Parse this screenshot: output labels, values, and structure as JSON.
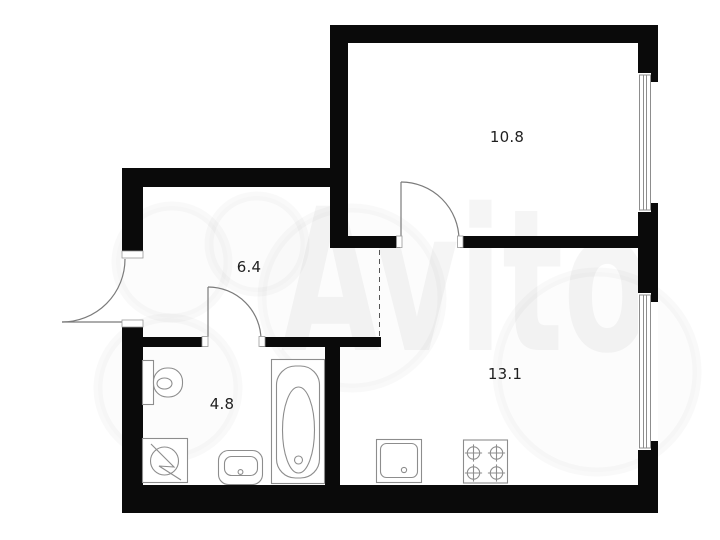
{
  "watermark": {
    "text": "Avito"
  },
  "rooms": [
    {
      "area_label": "10.8"
    },
    {
      "area_label": "6.4"
    },
    {
      "area_label": "4.8"
    },
    {
      "area_label": "13.1"
    }
  ],
  "fixtures": [
    "toilet-icon",
    "washing-machine-icon",
    "washbasin-icon",
    "bathtub-icon",
    "kitchen-sink-icon",
    "stove-icon"
  ],
  "colors": {
    "wall": "#0a0a0a",
    "fixture_outline": "#8d8d8d",
    "door_line": "#7b7b7b",
    "dashed_line": "#555555",
    "room_label": "#1f1f1f",
    "background": "#ffffff",
    "watermark": "rgba(0,0,0,0.04)"
  }
}
